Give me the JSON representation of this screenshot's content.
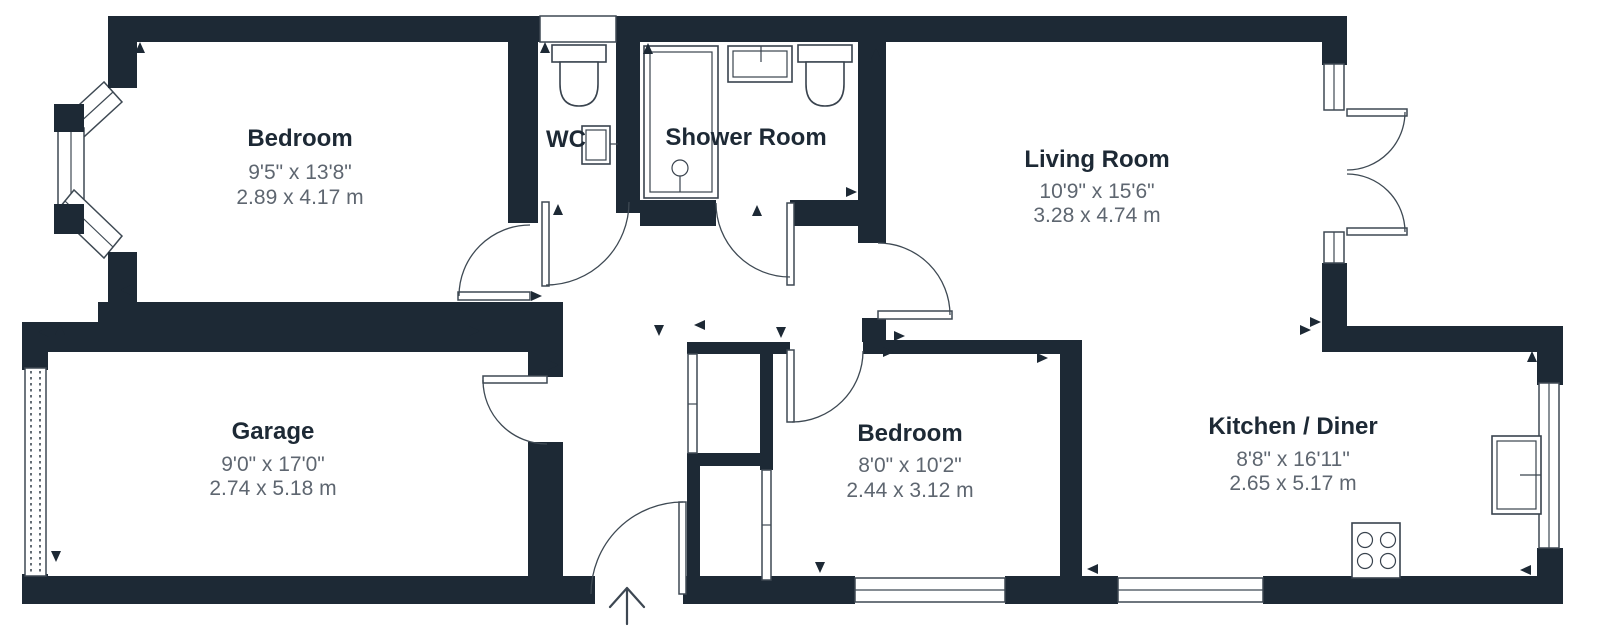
{
  "page": {
    "title": "Floor Plan",
    "type": "floor-plan-diagram"
  },
  "colors": {
    "wall": "#1d2935",
    "line": "#3e4953",
    "fixture_line": "#39434e",
    "room_name": "#1d2935",
    "dimensions_text": "#5e6670",
    "background": "#ffffff"
  },
  "rooms": [
    {
      "id": "bedroom-1",
      "name": "Bedroom",
      "dims_imperial": "9'5\" x 13'8\"",
      "dims_metric": "2.89 x 4.17 m"
    },
    {
      "id": "wc",
      "name": "WC",
      "dims_imperial": "",
      "dims_metric": ""
    },
    {
      "id": "shower-room",
      "name": "Shower Room",
      "dims_imperial": "",
      "dims_metric": ""
    },
    {
      "id": "living-room",
      "name": "Living Room",
      "dims_imperial": "10'9\" x 15'6\"",
      "dims_metric": "3.28 x 4.74 m"
    },
    {
      "id": "garage",
      "name": "Garage",
      "dims_imperial": "9'0\" x 17'0\"",
      "dims_metric": "2.74 x 5.18 m"
    },
    {
      "id": "bedroom-2",
      "name": "Bedroom",
      "dims_imperial": "8'0\" x 10'2\"",
      "dims_metric": "2.44 x 3.12 m"
    },
    {
      "id": "kitchen-diner",
      "name": "Kitchen / Diner",
      "dims_imperial": "8'8\" x 16'11\"",
      "dims_metric": "2.65 x 5.17 m"
    }
  ],
  "fixtures": [
    "toilet",
    "wash-basin",
    "shower-enclosure",
    "toilet",
    "wash-basin",
    "kitchen-sink",
    "hob",
    "bay-window",
    "french-doors",
    "garage-door",
    "entrance-arrow"
  ]
}
